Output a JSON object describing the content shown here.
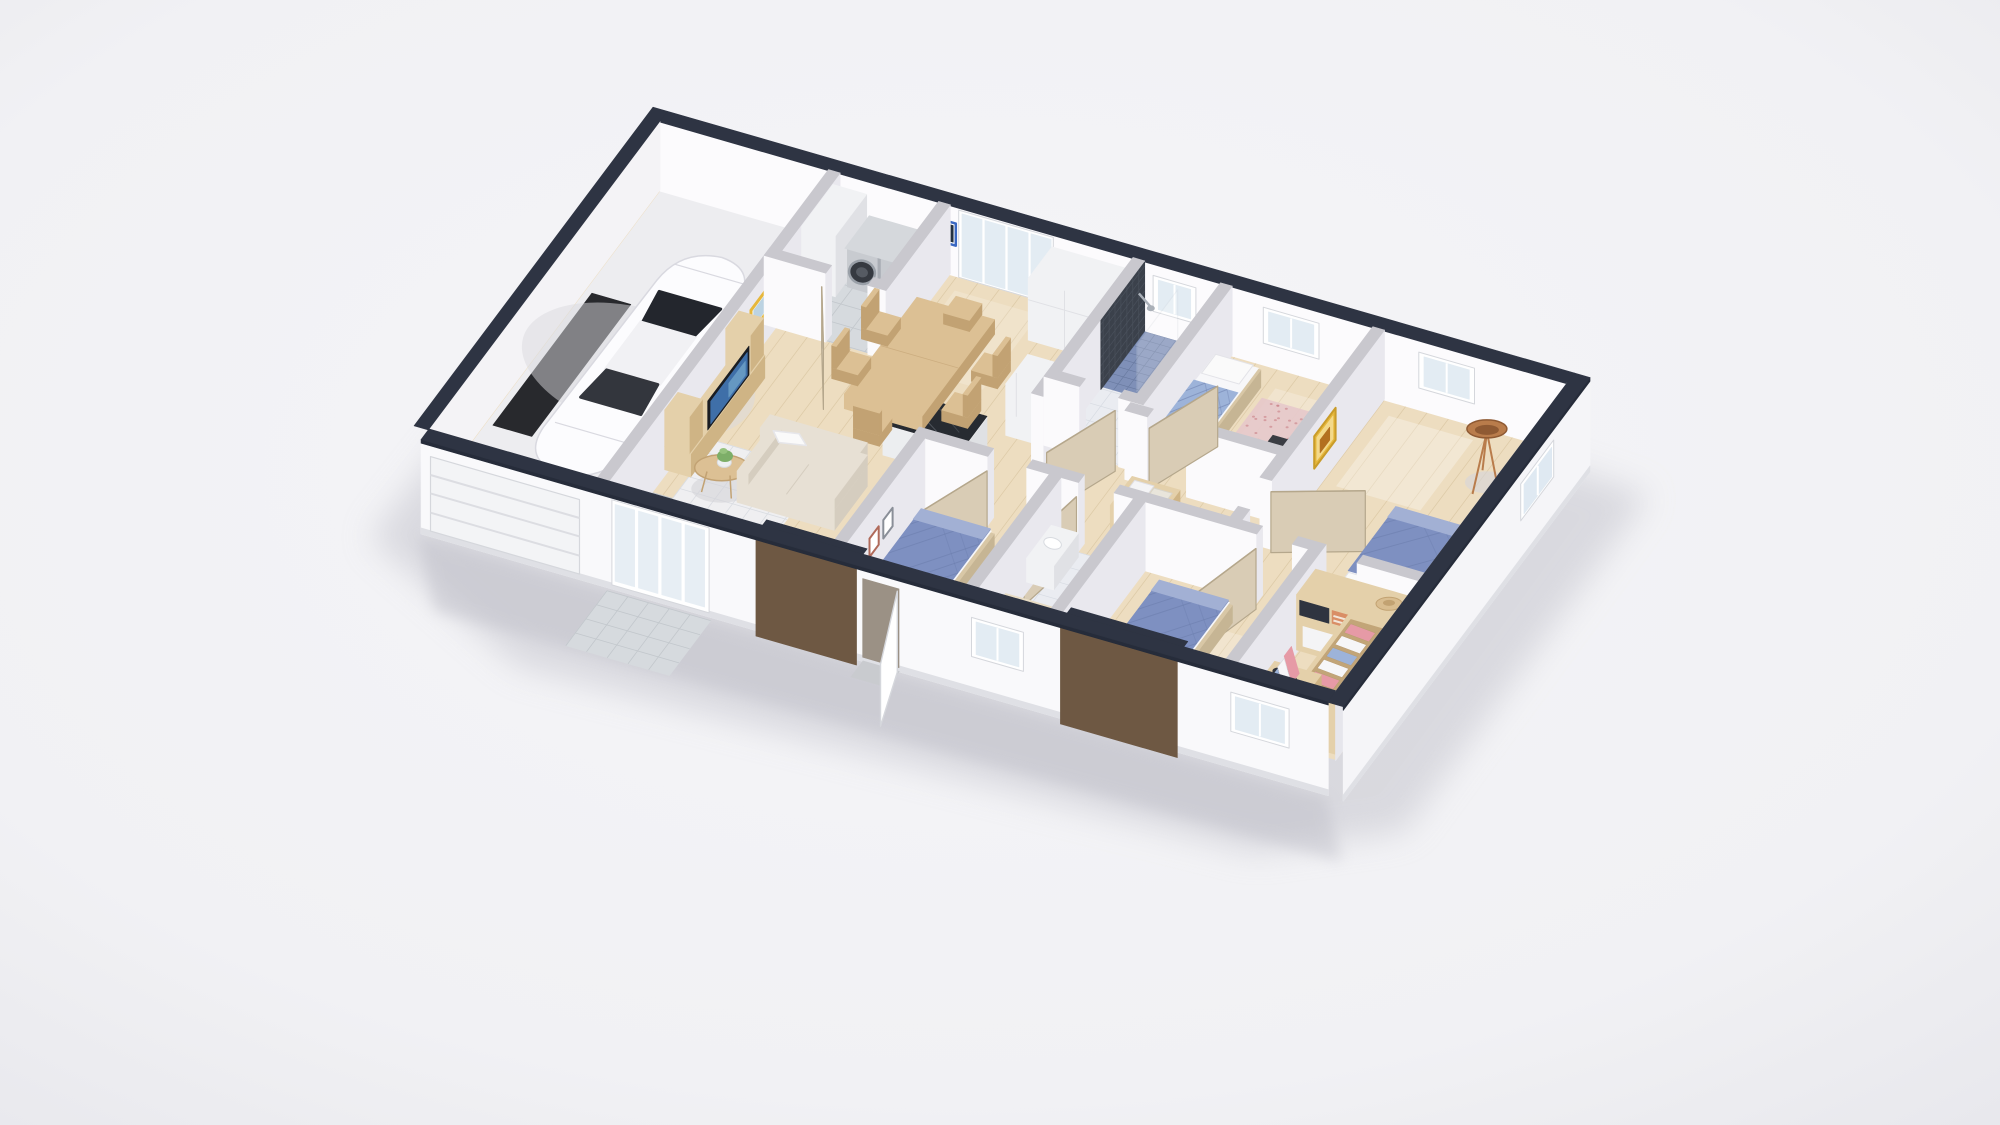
{
  "scene": {
    "type": "isometric-3d-floorplan-render",
    "background": "#f2f2f5",
    "view": "top-down-isometric-cutaway"
  },
  "palette": {
    "bg": "#f2f2f5",
    "vig": "#e5e5ea",
    "shadow": "#c5c5cd",
    "navy": "#262c3a",
    "navyTop": "#2e3443",
    "intTop": "#c9c8ce",
    "faceLit": "#fbfafc",
    "faceShade": "#e9e8ee",
    "cap": "#f3f2f5",
    "backFace": "#fcfbfd",
    "westFace": "#f4f3f6",
    "frontExt": "#f9f9fb",
    "eastInt": "#e6e6ec",
    "eastExt": "#f5f5f8",
    "plinth": "#dfe0e5",
    "wood": "#edddc0",
    "woodLine": "#d9c5a0",
    "garageFloor": "#ededf0",
    "mat": "#28292d",
    "tile": "#d6dade",
    "tileLine": "#c2c7cc",
    "bathTile": "#eaecf1",
    "bathLine": "#d7dbe2",
    "mosaic": "#7f90b8",
    "mosaicLine": "#68799f",
    "showerDark": "#3b414b",
    "glass": "#e3ecf3",
    "frameW": "#ffffff",
    "frameEdge": "#d5d7dc",
    "door": "#d9ccb5",
    "doorEdge": "#b5a78c",
    "bronze": "#6e5843",
    "bronzeDark": "#594531",
    "table": "#dcc094",
    "tableSide": "#c2a273",
    "counterTop": "#272b31",
    "cab": "#f1f2f4",
    "cabSide": "#e0e1e5",
    "silver": "#c8cbd0",
    "silverSide": "#a9adb4",
    "machDark": "#363a41",
    "machRing": "#9aa0a8",
    "sofa": "#e7e0d4",
    "sofaSide": "#d5cdbf",
    "pillow": "#fafafa",
    "rug": "#f0f1f4",
    "rugLine": "#d9dce1",
    "bedBlue": "#7e90c1",
    "bedQuilt": "#6a7cab",
    "bedWood": "#d8c7a6",
    "bedHead": "#c9b896",
    "sheet": "#f7f7f9",
    "rugPink": "#e7c9cb",
    "copper": "#b97c4b",
    "artY": "#e6b73c",
    "artBFrame": "#3a68c2",
    "artBFill": "#233140",
    "closet": "#e4d0aa",
    "closetSide": "#cfb485",
    "closetInner": "#c2a578",
    "clPink": "#e69aa6",
    "clBlue": "#9db3d9",
    "clWhite": "#f6f6f8",
    "towel": "#f4f4f6",
    "towel2": "#e9e5db",
    "plant": "#7dae68",
    "pot": "#edf0f2",
    "toilet": "#fbfcfe",
    "carBody": "#fcfcfe",
    "carEdge": "#d9d9e0",
    "carGlass": "#23262d",
    "carRoof": "#f1f1f4",
    "toyR": "#e04b3c",
    "toyY": "#f2c23c",
    "toyB": "#4a7fd4"
  },
  "building": {
    "exterior_features": [
      "dark-navy-wall-tops",
      "white-garage-door",
      "sliding-glass-door",
      "bronze-entry-panel",
      "open-white-entry-door",
      "front-windows",
      "bronze-facade-panel",
      "white-plinth"
    ],
    "rooms": [
      {
        "id": "garage",
        "contents": [
          "white-car",
          "dark-floor-mat",
          "segmented-garage-door"
        ]
      },
      {
        "id": "laundry-room",
        "contents": [
          "tall-white-cabinet",
          "washing-machine",
          "dryer",
          "gray-tile-floor"
        ]
      },
      {
        "id": "kitchen-dining",
        "contents": [
          "wood-dining-table",
          "six-wood-chairs",
          "black-marble-island",
          "tall-white-cabinets",
          "fridge-cabinet",
          "patio-sliding-glass-doors",
          "blue-framed-art"
        ]
      },
      {
        "id": "living-room",
        "contents": [
          "beige-sofa",
          "white-throw-pillow",
          "round-coffee-table",
          "potted-plant",
          "grid-rug",
          "tv-console",
          "tv-screen",
          "yellow-framed-art",
          "toys",
          "entry-tile"
        ]
      },
      {
        "id": "hallway",
        "contents": [
          "wood-linen-shelf",
          "white-towels",
          "interior-doors"
        ]
      },
      {
        "id": "shower-bathroom",
        "contents": [
          "dark-mosaic-shower-wall",
          "blue-mosaic-shower-floor",
          "glass-screen",
          "toilet",
          "back-window"
        ]
      },
      {
        "id": "kids-bedroom",
        "contents": [
          "day-bed",
          "pink-speckled-rug",
          "dark-desk",
          "chair",
          "back-window"
        ]
      },
      {
        "id": "master-bedroom",
        "contents": [
          "blue-quilted-double-bed",
          "copper-tripod-lamp",
          "yellow-framed-art",
          "back-window",
          "side-window"
        ]
      },
      {
        "id": "front-bedroom-left",
        "contents": [
          "blue-quilted-double-bed",
          "small-wall-frames"
        ]
      },
      {
        "id": "tub-bathroom",
        "contents": [
          "bathtub",
          "white-vanity",
          "front-window"
        ]
      },
      {
        "id": "front-bedroom-right",
        "contents": [
          "blue-quilted-double-bed",
          "front-windows",
          "bronze-facade-panel"
        ]
      },
      {
        "id": "walk-in-closet",
        "contents": [
          "wardrobe-shelving",
          "hanging-clothes",
          "shoe-shelf",
          "storage-boxes",
          "sun-hat",
          "front-window"
        ]
      }
    ]
  }
}
